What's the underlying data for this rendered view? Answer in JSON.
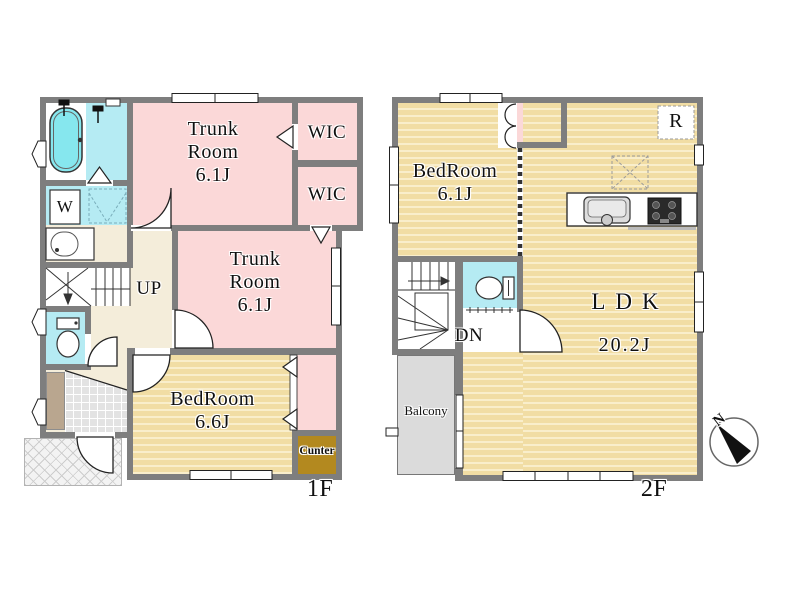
{
  "floor1": {
    "label": "1F",
    "trunk_room_upper": "Trunk\nRoom\n6.1J",
    "trunk_room_lower": "Trunk\nRoom\n6.1J",
    "wic_upper": "WIC",
    "wic_lower": "WIC",
    "bedroom": "BedRoom\n6.6J",
    "counter": "Cunter",
    "washer": "W",
    "stairs": "UP"
  },
  "floor2": {
    "label": "2F",
    "bedroom": "BedRoom\n6.1J",
    "ldk_name": "LDK",
    "ldk_size": "20.2J",
    "refrigerator": "R",
    "stairs": "DN",
    "balcony": "Balcony"
  },
  "compass": {
    "north": "N"
  },
  "colors": {
    "wall": "#7e7e7e",
    "pink": "#fbd8d8",
    "tan_base": "#f1dda4",
    "tan_stripe": "#f9eecb",
    "cyan": "#b5ebf3",
    "tub": "#86e7ee",
    "hall": "#f4edda",
    "balcony": "#dbdbdb",
    "counter": "#b3891f",
    "tile": "#e3e3e3",
    "cabinet": "#b9a68f",
    "porch": "#f3f3f3"
  },
  "icons": {
    "compass": "north-arrow-wedge",
    "bathtub": "rounded-tub-outline",
    "shower": "shower-head",
    "washbasin": "oval-basin",
    "toilet": "tank-and-bowl",
    "kitchen_sink": "rounded-basin-with-faucet",
    "stove": "dark-burner-grid",
    "skylight_cross": "dashed-x-square"
  }
}
